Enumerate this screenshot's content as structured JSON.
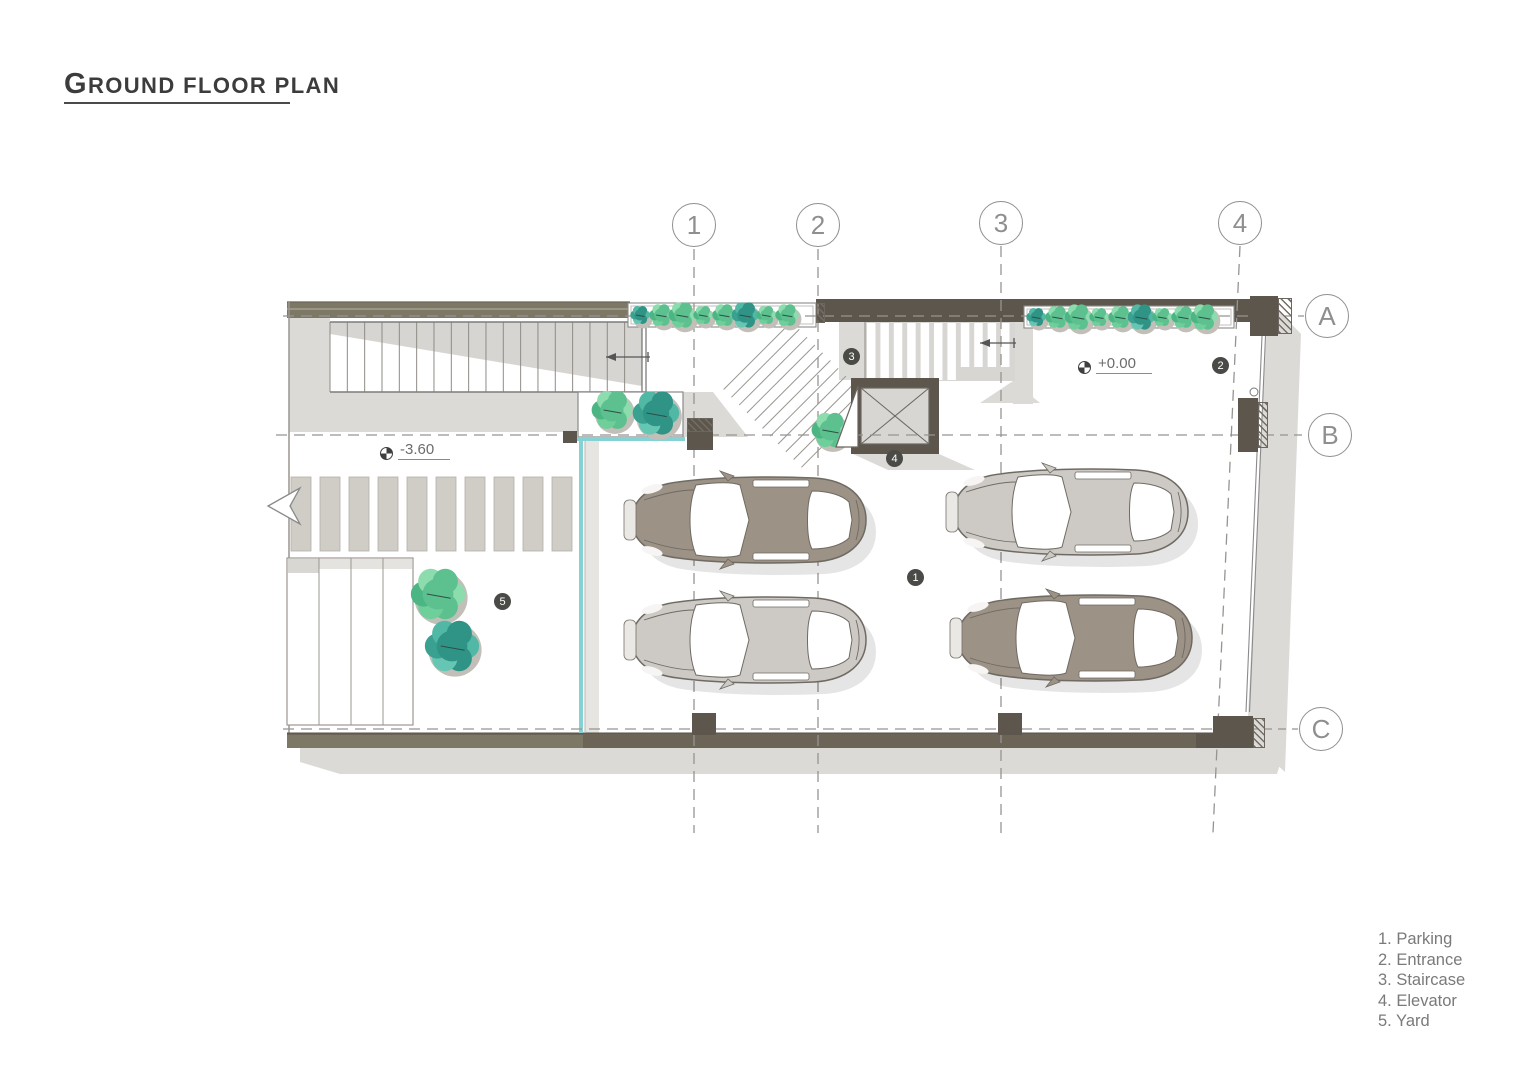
{
  "title": "GROUND FLOOR PLAN",
  "grid": {
    "columns": [
      "1",
      "2",
      "3",
      "4"
    ],
    "rows": [
      "A",
      "B",
      "C"
    ]
  },
  "levels": {
    "parking": "-3.60",
    "entrance": "+0.00"
  },
  "badges": {
    "parking": "1",
    "entrance": "2",
    "staircase": "3",
    "elevator": "4",
    "yard": "5"
  },
  "legend": {
    "items": [
      "1. Parking",
      "2. Entrance",
      "3. Staircase",
      "4. Elevator",
      "5. Yard"
    ]
  },
  "colors": {
    "wall_dark": "#5d564d",
    "wall_olive": "#7d7766",
    "shadow": "#dcdad7",
    "green": "#5cc18f",
    "teal_glass": "#85d2d4",
    "badge": "#4a4a47"
  }
}
